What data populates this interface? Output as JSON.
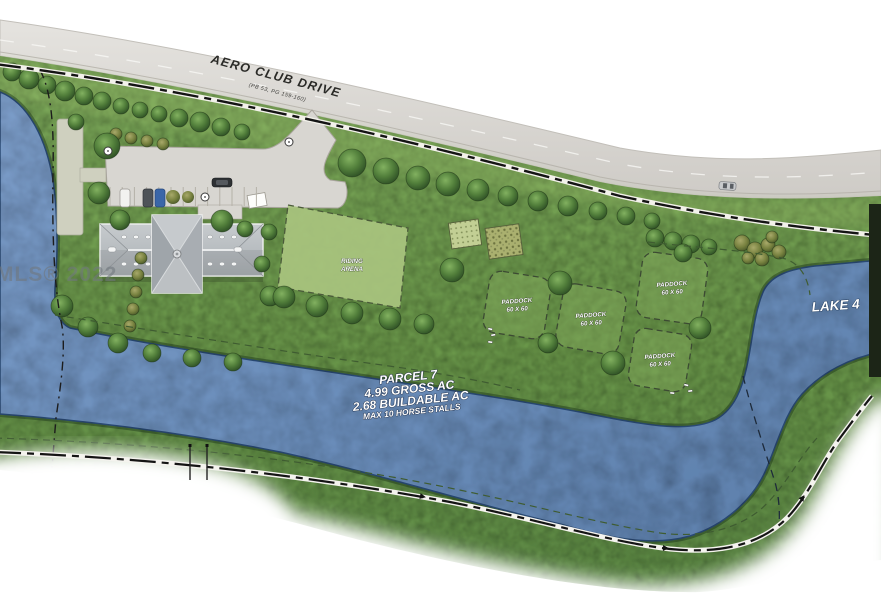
{
  "watermark": {
    "text": "MLS® 2022"
  },
  "road": {
    "name": "AERO CLUB DRIVE",
    "plat": "(PB 53, PG 159-160)"
  },
  "site": {
    "arena": {
      "line1": "RIDING",
      "line2": "ARENA"
    },
    "paddocks": [
      {
        "name": "PADDOCK",
        "size": "60 X 60"
      },
      {
        "name": "PADDOCK",
        "size": "60 X 60"
      },
      {
        "name": "PADDOCK",
        "size": "60 X 60"
      },
      {
        "name": "PADDOCK",
        "size": "60 X 60"
      }
    ],
    "lake": {
      "name": "LAKE 4"
    },
    "parcel": {
      "title": "PARCEL 7",
      "gross": "4.99 GROSS AC",
      "buildable": "2.68 BUILDABLE AC",
      "note": "MAX 10 HORSE STALLS"
    }
  },
  "colors": {
    "grass": "#6E9A4E",
    "grass-light": "#A9C47F",
    "water": "#6C8FBC",
    "water-edge": "#2A4A74",
    "road": "#D8D5D0",
    "pavement": "#D8D6D1",
    "roof": "#B9BDC0",
    "tree": "#4F7A3B",
    "boundary": "#141414",
    "dark-bar": "#1C2517"
  }
}
